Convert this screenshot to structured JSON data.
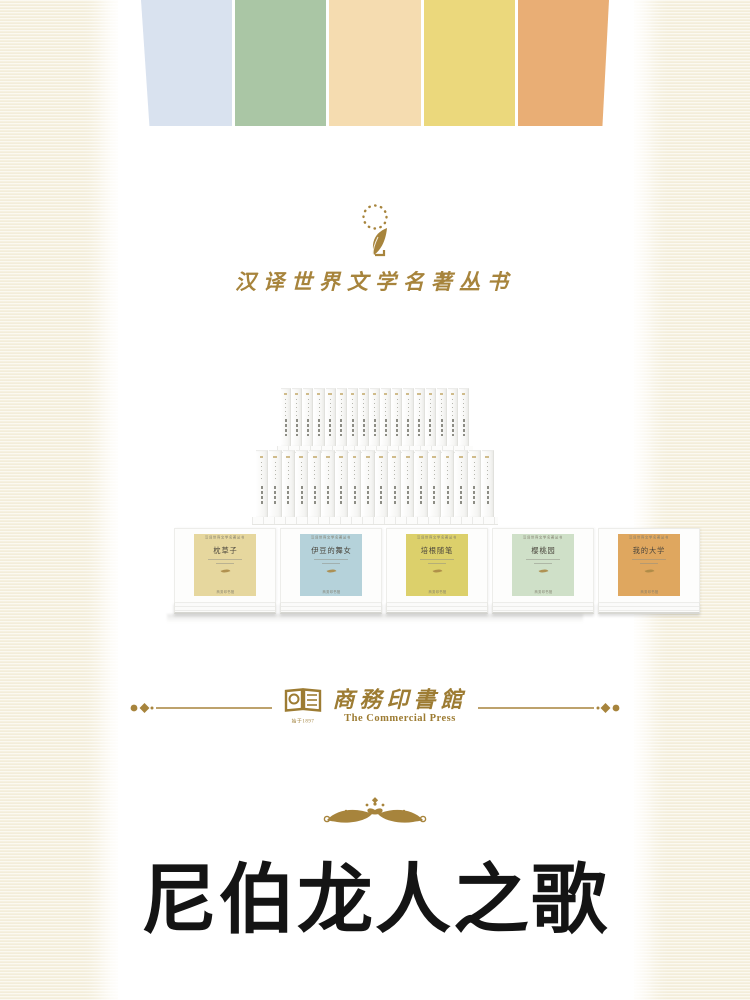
{
  "poster": {
    "background_color": "#f6f1e0",
    "panel_color": "#ffffff",
    "gold": "#a7843c"
  },
  "top_stripes": {
    "colors": [
      "#d9e2ef",
      "#aac6a5",
      "#f5dcb0",
      "#ebd87c",
      "#e9ae75"
    ]
  },
  "series_header": {
    "emblem": "quill-in-dotted-circle-icon",
    "title": "汉译世界文学名著丛书"
  },
  "book_display": {
    "back_row": {
      "spine_count": 17
    },
    "middle_row": {
      "spine_count": 18
    },
    "front_row": {
      "series_label": "汉译世界文学名著丛书",
      "publisher_label": "商务印书馆",
      "books": [
        {
          "title": "枕草子",
          "panel_color": "#e6d79e"
        },
        {
          "title": "伊豆的舞女",
          "panel_color": "#b5d2da"
        },
        {
          "title": "培根随笔",
          "panel_color": "#dcd06b"
        },
        {
          "title": "樱桃园",
          "panel_color": "#cfe0c8"
        },
        {
          "title": "我的大学",
          "panel_color": "#dfa75f"
        }
      ]
    }
  },
  "publisher_logo": {
    "book_icon": "open-book-icon",
    "since_label": "始于1897",
    "name_cn": "商務印書館",
    "name_en": "The Commercial Press"
  },
  "footer": {
    "ornament": "gold-flourish-ornament",
    "main_title": "尼伯龙人之歌"
  }
}
